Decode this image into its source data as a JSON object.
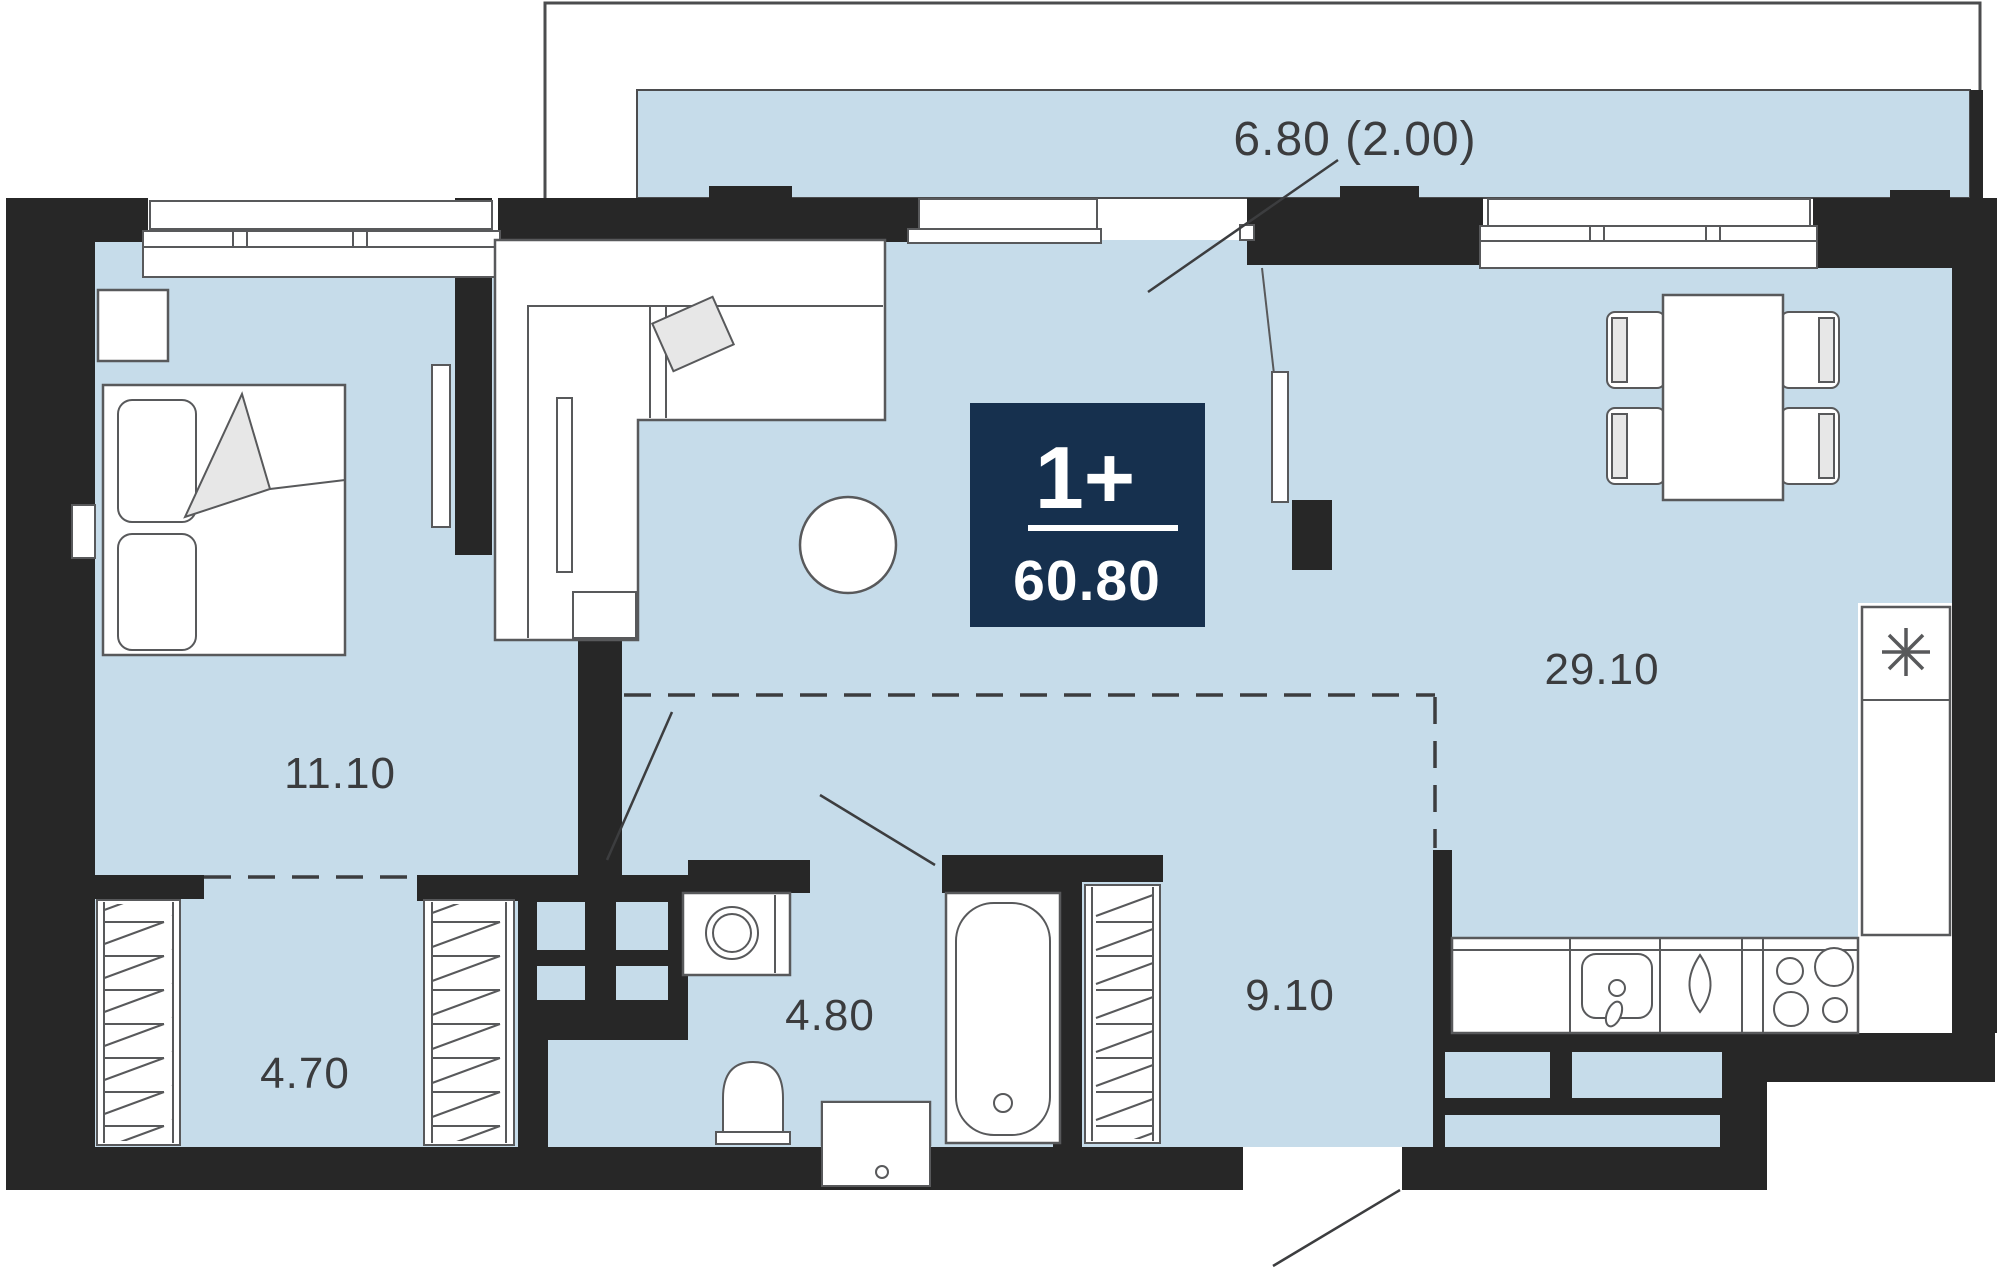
{
  "plan": {
    "type": "apartment-floor-plan",
    "badge": {
      "rooms": "1+",
      "area": "60.80",
      "bg_color": "#16304e",
      "text_color": "#ffffff"
    },
    "labels": {
      "balcony": "6.80 (2.00)",
      "bedroom": "11.10",
      "living": "29.10",
      "wardrobe": "4.70",
      "bathroom": "4.80",
      "hallway": "9.10"
    },
    "colors": {
      "floor": "#c6dcea",
      "wall": "#272727",
      "outline": "#58595b",
      "label_text": "#3b3c3e",
      "badge": "#16304e"
    },
    "icons": {
      "freezer": "snowflake-asterisk-icon",
      "stove": "four-burners-icon",
      "sink_drop": "water-drop-icon"
    }
  }
}
